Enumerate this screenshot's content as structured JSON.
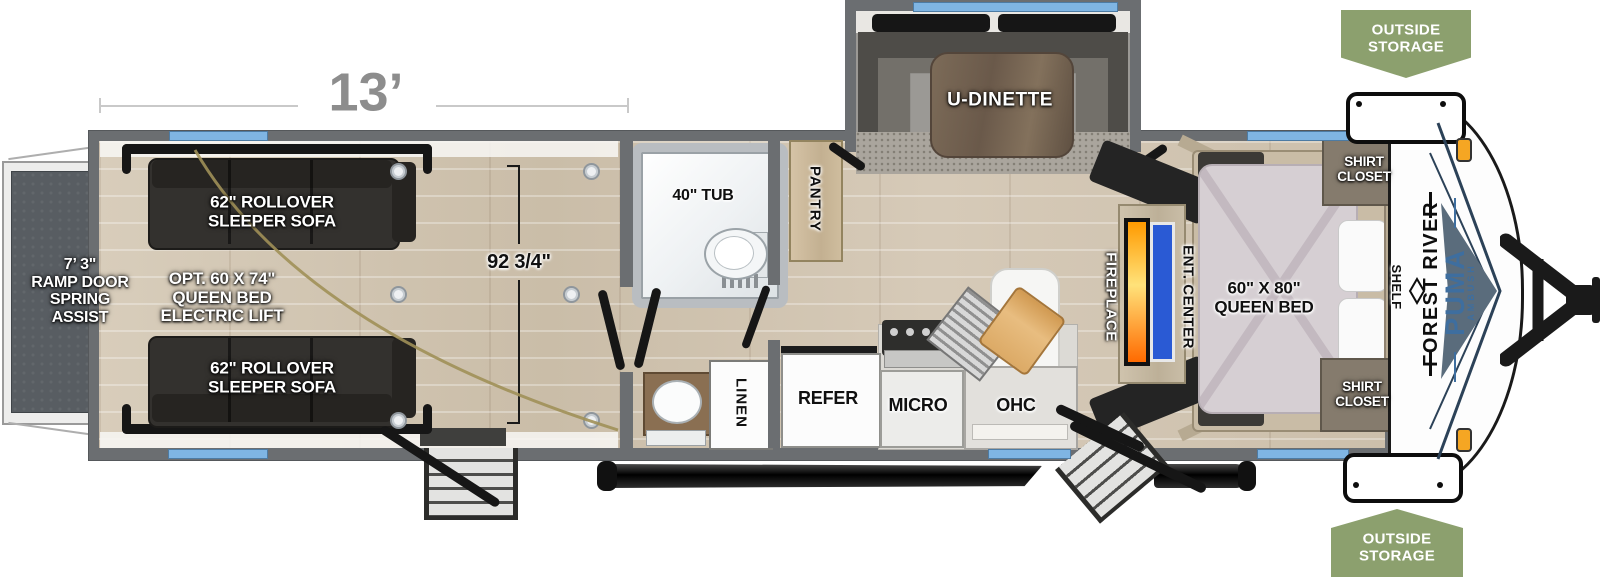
{
  "brand": {
    "manufacturer": "FOREST RIVER",
    "model": "PUMA",
    "edition": "AMBUSH"
  },
  "dimensions": {
    "box_length": "13’",
    "garage_interior_width": "92 3/4\"",
    "ramp_door": "7’ 3\"\nRAMP DOOR\nSPRING\nASSIST"
  },
  "badges": {
    "outside_storage": "OUTSIDE\nSTORAGE"
  },
  "garage": {
    "sleeper_sofa": "62\" ROLLOVER\nSLEEPER SOFA",
    "bed_option": "OPT. 60 X 74\"\nQUEEN BED\nELECTRIC LIFT"
  },
  "kitchen": {
    "dinette": "U-DINETTE",
    "pantry": "PANTRY",
    "refrigerator": "REFER",
    "microwave": "MICRO",
    "overhead_cabinet": "OHC"
  },
  "bathroom": {
    "tub": "40\" TUB",
    "linen_closet": "LINEN"
  },
  "living": {
    "fireplace": "FIREPLACE",
    "entertainment_center": "ENT. CENTER"
  },
  "bedroom": {
    "queen_bed": "60\" X 80\"\nQUEEN BED",
    "shirt_closet": "SHIRT\nCLOSET",
    "shelf": "SHELF"
  },
  "colors": {
    "wall_gray": "#6b6e71",
    "window_blue": "#7fb5e3",
    "badge_green": "#8ca06e",
    "fireplace_orange": "#ff8a00",
    "tv_blue": "#2a5ad4",
    "puma_blue": "#3e6e9f",
    "floor_wood": "#d2c6b4",
    "ramp_gray": "#585d62"
  }
}
